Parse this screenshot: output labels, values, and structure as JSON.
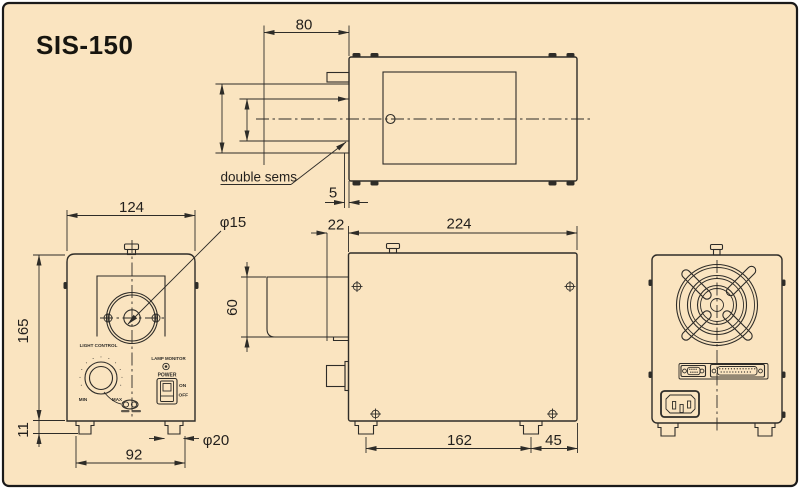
{
  "title": "SIS-150",
  "colors": {
    "background": "#fae4c0",
    "line": "#2e2c28",
    "frame": "#1a1a1a"
  },
  "views": {
    "top": {
      "dim_80": "80",
      "dim_5": "5",
      "note": "double sems"
    },
    "front": {
      "dim_width": "124",
      "dim_height": "165",
      "dim_foot_height": "11",
      "dim_foot_span": "92",
      "dia_lens": "φ15",
      "dia_foot": "φ20",
      "panel": {
        "light_control": "LIGHT CONTROL",
        "min": "MIN",
        "max": "MAX",
        "lamp_monitor": "LAMP MONITOR",
        "power": "POWER",
        "on": "ON",
        "off": "OFF"
      }
    },
    "side": {
      "dim_offset": "22",
      "dim_depth": "224",
      "dim_bracket": "60",
      "dim_foot_span": "162",
      "dim_foot_to_rear": "45"
    }
  }
}
